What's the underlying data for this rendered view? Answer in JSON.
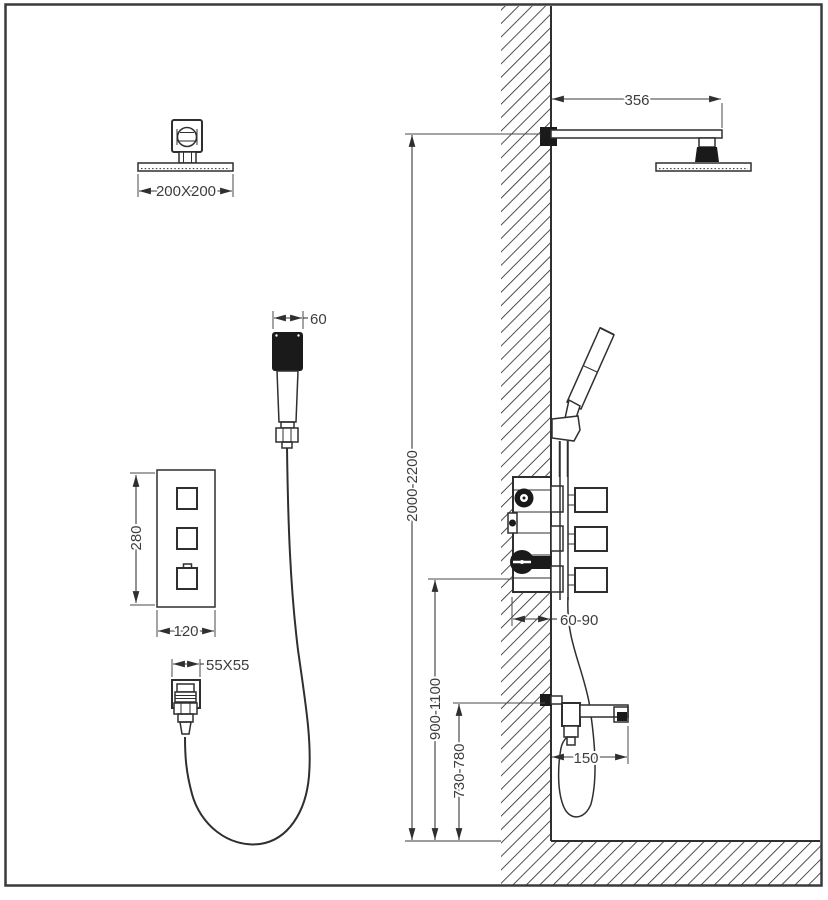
{
  "diagram": {
    "type": "shower-system-installation-drawing",
    "colors": {
      "line": "#2f2f2f",
      "dark_fill": "#1a1a1a",
      "text": "#3d3d3d",
      "background": "#ffffff"
    },
    "dims": {
      "head_size": "200X200",
      "handshower_width": "60",
      "panel_height": "280",
      "panel_width": "120",
      "outlet_size": "55X55",
      "arm_length": "356",
      "overhead_height": "2000-2200",
      "valve_height": "900-1100",
      "spout_height": "730-780",
      "valve_depth": "60-90",
      "spout_reach": "150"
    }
  }
}
